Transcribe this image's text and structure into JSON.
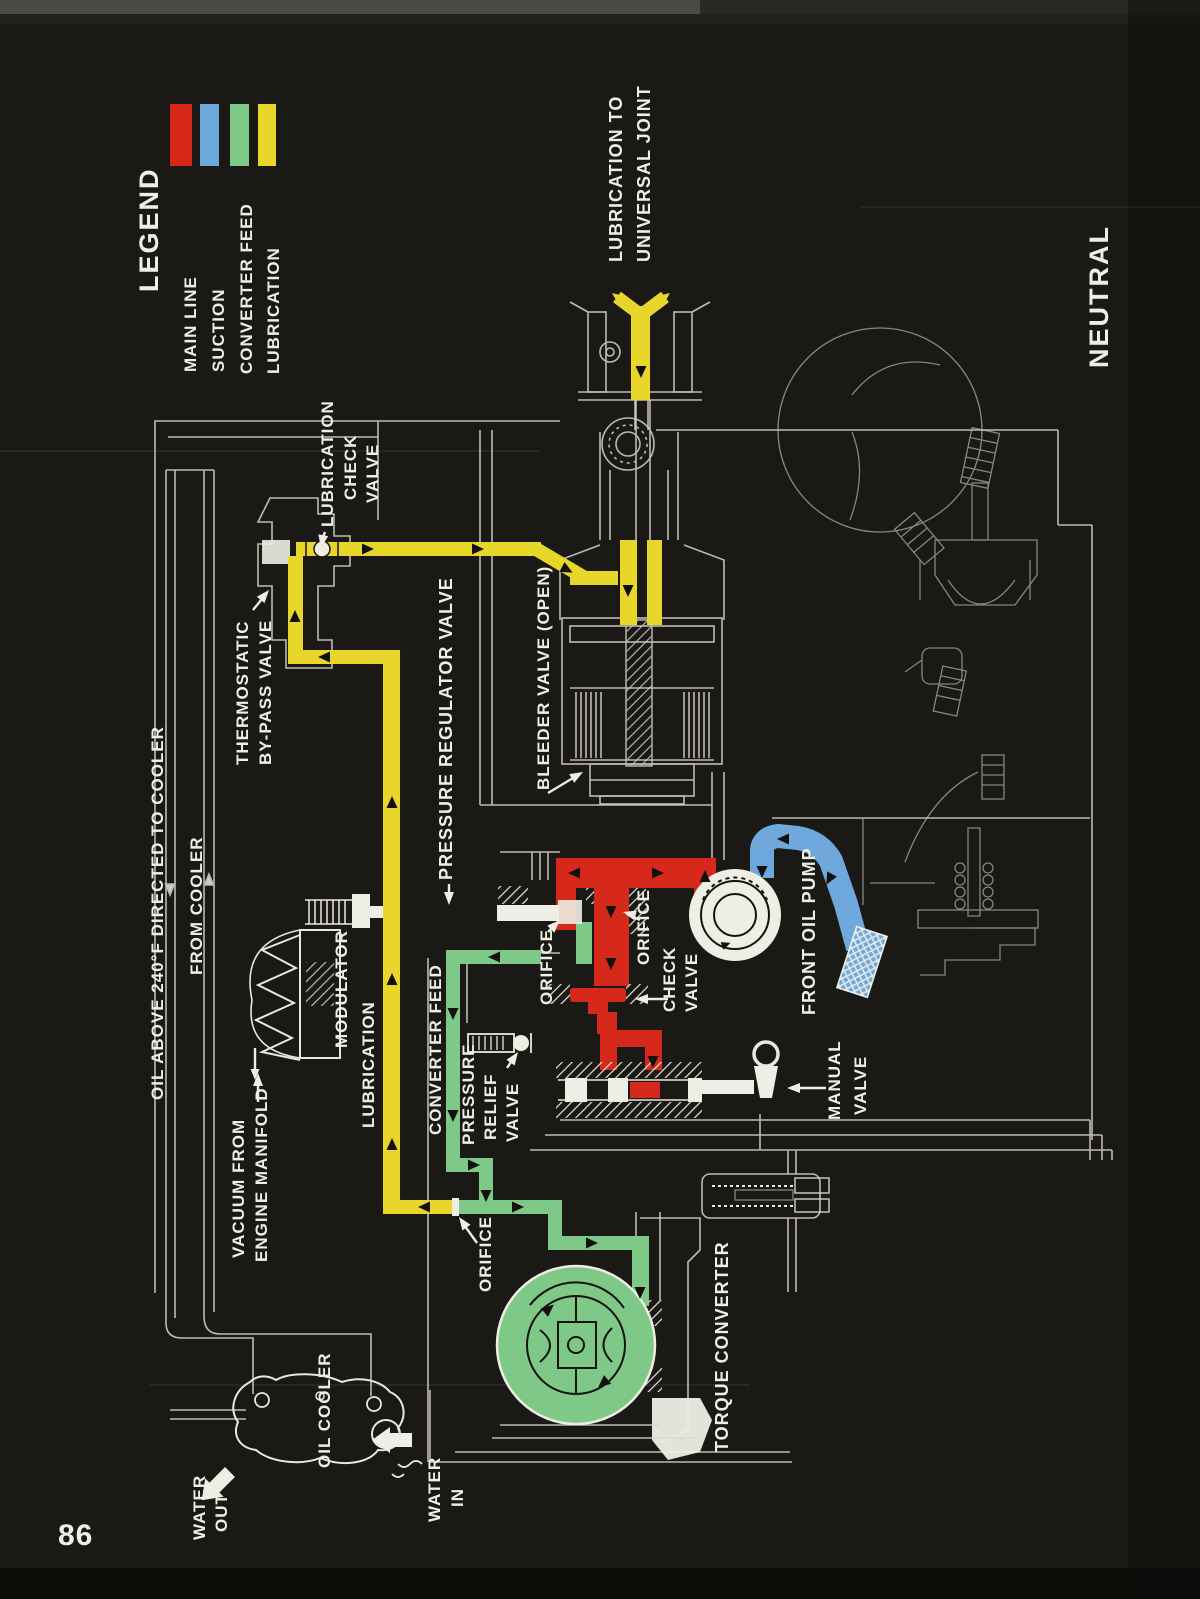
{
  "page": {
    "number": "86",
    "mode_label": "NEUTRAL"
  },
  "colors": {
    "main_line": "#d6291b",
    "suction": "#6fa8dc",
    "converter_feed": "#7ec888",
    "lubrication": "#e9d62b",
    "line_art": "#e9e8df",
    "background": "#1a1915"
  },
  "legend": {
    "title": "LEGEND",
    "items": [
      {
        "label": "MAIN LINE",
        "color": "#d6291b"
      },
      {
        "label": "SUCTION",
        "color": "#6fa8dc"
      },
      {
        "label": "CONVERTER FEED",
        "color": "#7ec888"
      },
      {
        "label": "LUBRICATION",
        "color": "#e9d62b"
      }
    ]
  },
  "labels": {
    "lubrication_to_universal_joint": [
      "LUBRICATION TO",
      "UNIVERSAL JOINT"
    ],
    "lubrication_check_valve": [
      "LUBRICATION",
      "CHECK",
      "VALVE"
    ],
    "thermostatic_bypass_valve": [
      "THERMOSTATIC",
      "BY-PASS VALVE"
    ],
    "bleeder_valve": "BLEEDER VALVE (OPEN)",
    "oil_above_240": "OIL ABOVE 240°F DIRECTED TO COOLER",
    "from_cooler": "FROM COOLER",
    "pressure_regulator_valve": "PRESSURE REGULATOR VALVE",
    "modulator": "MODULATOR",
    "vacuum_from_engine_manifold": [
      "VACUUM FROM",
      "ENGINE MANIFOLD"
    ],
    "lubrication_flow": "LUBRICATION",
    "converter_feed_flow": "CONVERTER FEED",
    "pressure_relief_valve": [
      "PRESSURE",
      "RELIEF",
      "VALVE"
    ],
    "orifice_regulator": "ORIFICE",
    "orifice_main": "ORIFICE",
    "orifice_lubrication": "ORIFICE",
    "check_valve": [
      "CHECK",
      "VALVE"
    ],
    "front_oil_pump": "FRONT OIL PUMP",
    "manual_valve": [
      "MANUAL",
      "VALVE"
    ],
    "oil_cooler": "OIL COOLER",
    "water_out": [
      "WATER",
      "OUT"
    ],
    "water_in": [
      "WATER",
      "IN"
    ],
    "torque_converter": "TORQUE CONVERTER"
  }
}
